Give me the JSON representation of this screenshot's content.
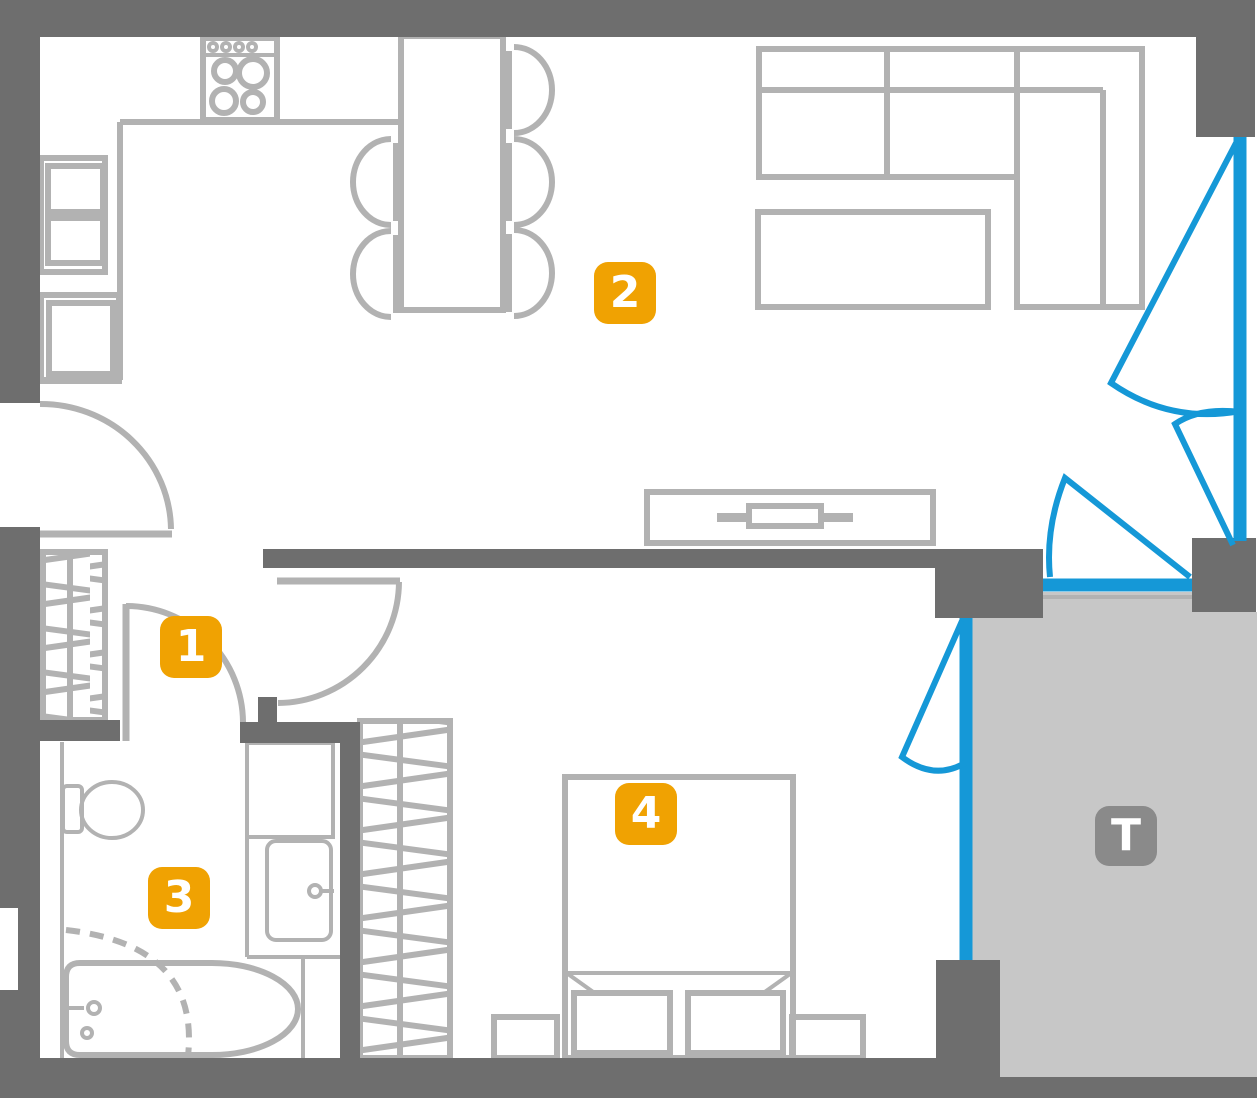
{
  "plan": {
    "room_labels": [
      {
        "id": "room-1",
        "text": "1"
      },
      {
        "id": "room-2",
        "text": "2"
      },
      {
        "id": "room-3",
        "text": "3"
      },
      {
        "id": "room-4",
        "text": "4"
      }
    ],
    "terrace_label": {
      "text": "T"
    },
    "colors": {
      "wall": "#6e6e6e",
      "furniture": "#b2b2b2",
      "window": "#1598d7",
      "room_badge": "#f0a202",
      "terrace_badge": "#8a8a8a",
      "terrace_floor": "#c7c7c7",
      "badge_text": "#ffffff",
      "background": "#ffffff"
    }
  }
}
